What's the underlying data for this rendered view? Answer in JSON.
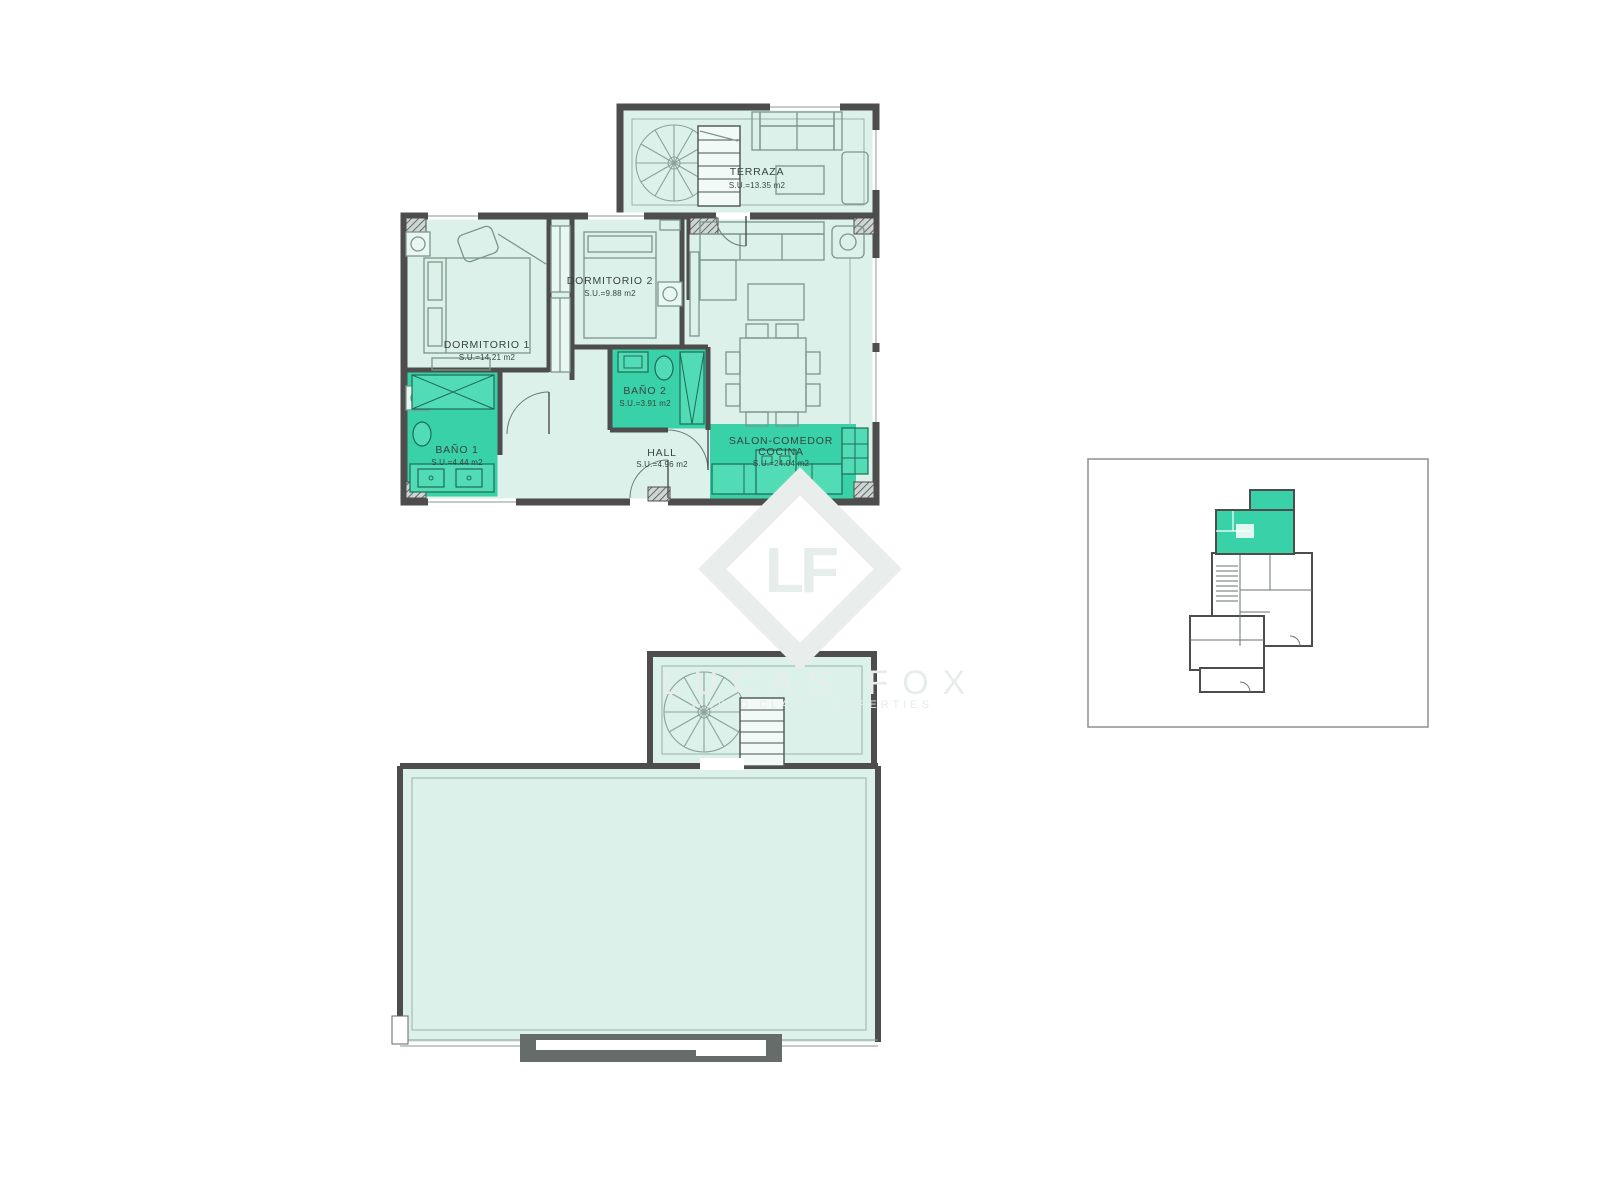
{
  "main_plan": {
    "rooms": {
      "terraza": {
        "name": "TERRAZA",
        "area": "S.U.=13.35 m2"
      },
      "dormitorio1": {
        "name": "DORMITORIO 1",
        "area": "S.U.=14.21 m2"
      },
      "dormitorio2": {
        "name": "DORMITORIO 2",
        "area": "S.U.=9.88 m2"
      },
      "bano1": {
        "name": "BAÑO 1",
        "area": "S.U.=4.44 m2"
      },
      "bano2": {
        "name": "BAÑO 2",
        "area": "S.U.=3.91 m2"
      },
      "hall": {
        "name": "HALL",
        "area": "S.U.=4.96 m2"
      },
      "salon": {
        "name_line1": "SALON-COMEDOR",
        "name_line2": "COCINA",
        "area": "S.U.=24.04 m2"
      }
    }
  },
  "watermark": {
    "logo": "LF",
    "brand": "LUCAS FOX",
    "tagline": "WORLD CLASS PROPERTIES"
  },
  "colors": {
    "highlight": "#38d1a8",
    "room_fill": "#dbf1e9",
    "wall": "#4d4d4d"
  }
}
